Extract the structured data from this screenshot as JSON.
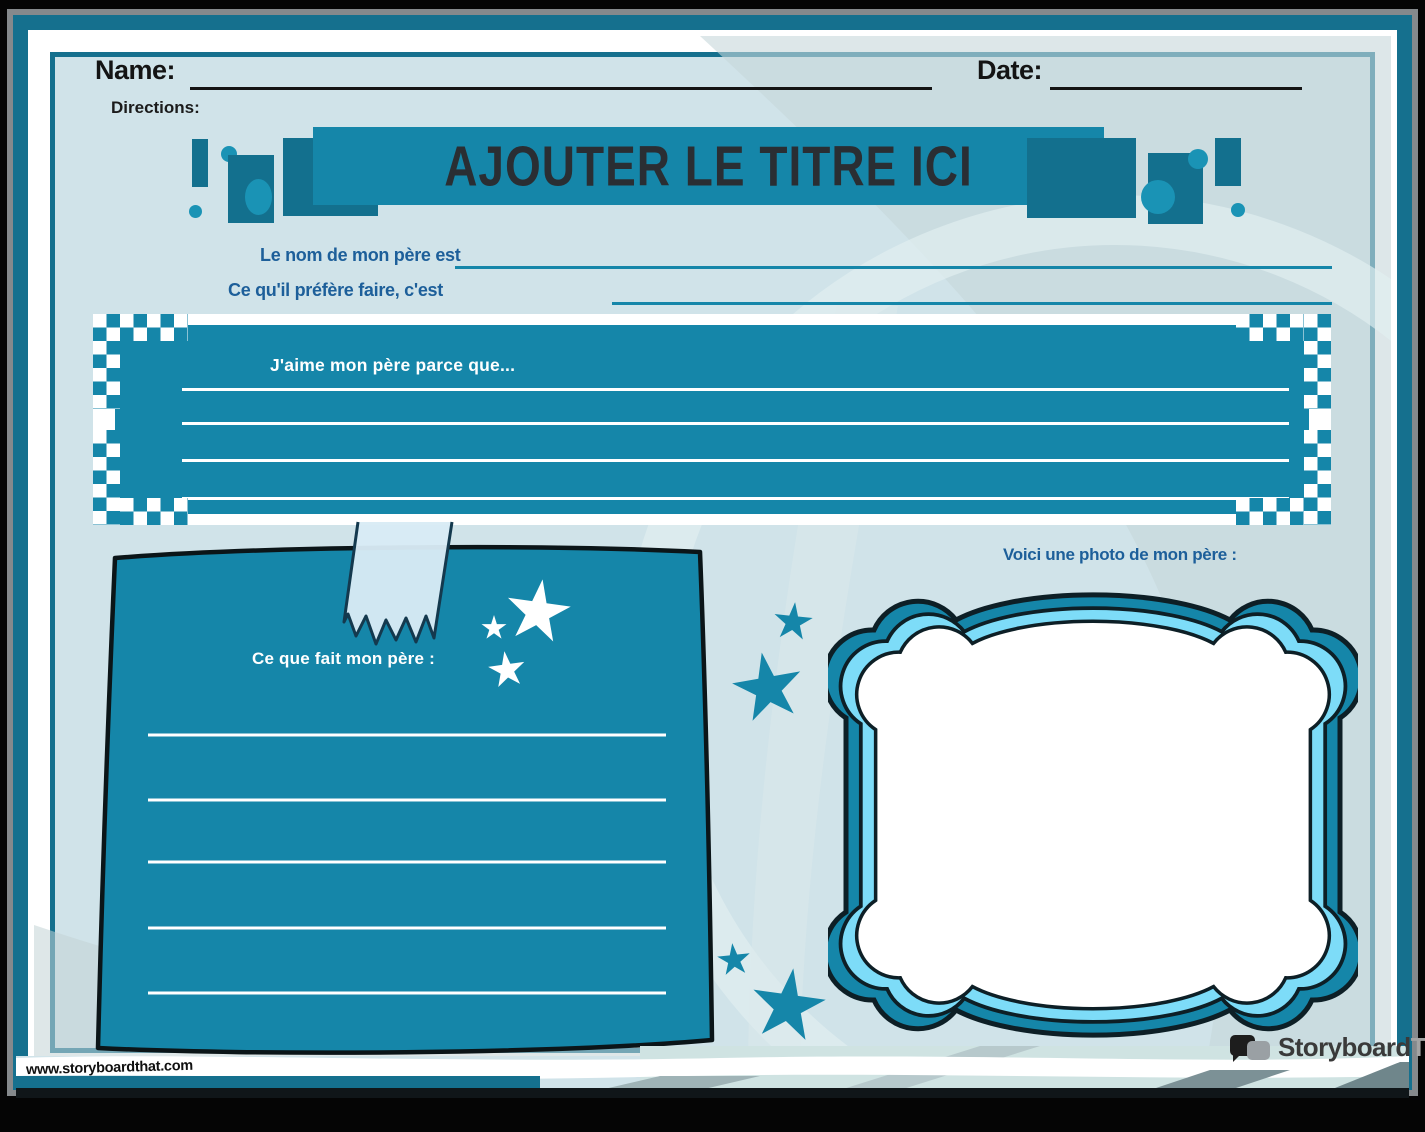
{
  "header": {
    "name_label": "Name:",
    "date_label": "Date:",
    "directions_label": "Directions:"
  },
  "banner": {
    "title": "AJOUTER LE TITRE ICI"
  },
  "prompts": {
    "father_name": "Le nom de mon père est",
    "favorite_activity": "Ce qu'il préfère faire, c'est",
    "love_reason": "J'aime mon père parce que...",
    "father_does": "Ce que fait mon père :",
    "photo_caption": "Voici une photo de mon père :"
  },
  "footer": {
    "watermark": "www.storyboardthat.com",
    "logo_primary": "Storyboard",
    "logo_secondary": "That"
  },
  "icons": {
    "star_icon": "five-point star (css clip-path)",
    "tape_icon": "torn washi-tape strip (svg polygon)",
    "speech_bubble_icon": "two overlapping rounded speech bubbles"
  },
  "colors": {
    "primary_teal": "#1586a9",
    "dark_teal": "#13708e",
    "bright_teal": "#1a93b5",
    "accent_blue": "#1d5f9a",
    "page_bg": "#d0e3e9",
    "border_teal": "#15708e",
    "frame_cyan": "#7ddcf8",
    "banner_text": "#2a2e33",
    "swirl_gray": "#c6d7da",
    "mint": "#cfe3e2"
  }
}
